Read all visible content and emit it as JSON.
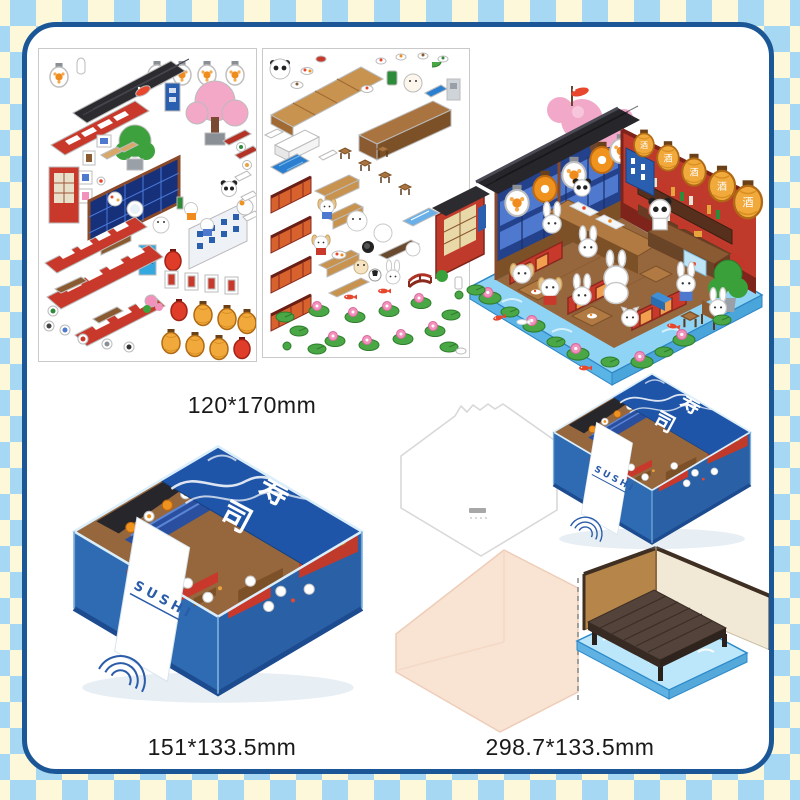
{
  "labels": {
    "sticker_sheets": "120*170mm",
    "box": "151*133.5mm",
    "base": "298.7*133.5mm"
  },
  "box": {
    "noren_char_1": "寿",
    "noren_char_2": "司",
    "band_text": "SUSHI"
  },
  "scene": {
    "lantern_text": "酒"
  },
  "theme": {
    "checker_blue": "#a6d8f3",
    "checker_cream": "#fcf8d9",
    "frame_navy": "#1b5796",
    "panel_white": "#ffffff",
    "box_blue": "#2e6bb2",
    "noren_blue": "#1e55a8",
    "wall_red": "#c03a2c",
    "lantern_gold": "#f2a93b",
    "water_blue": "#8fd4f4",
    "mat_peach": "#f9e3d2",
    "deck_brown": "#54433a"
  }
}
